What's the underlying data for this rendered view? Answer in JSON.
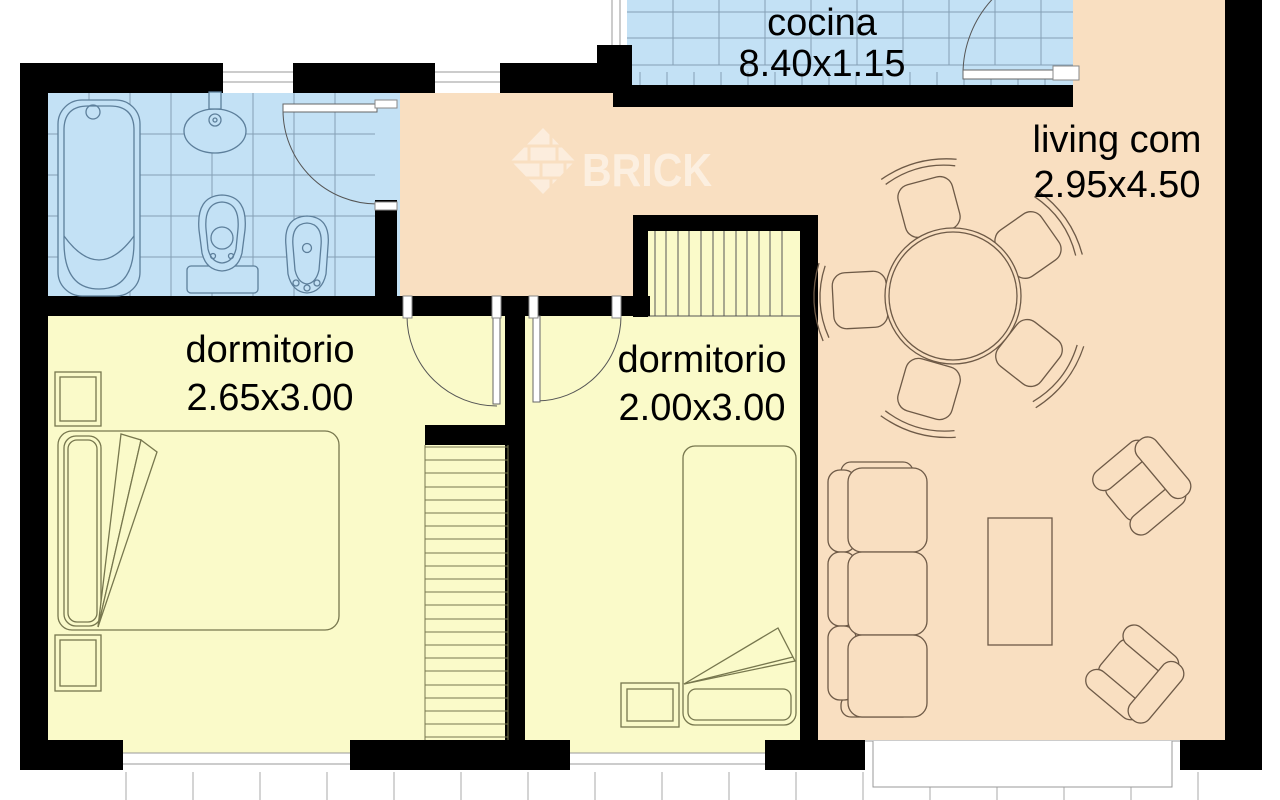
{
  "watermark": {
    "text": "BRICK"
  },
  "rooms": {
    "kitchen": {
      "label": "cocina",
      "dimensions": "8.40x1.15"
    },
    "living": {
      "label": "living com",
      "dimensions": "2.95x4.50"
    },
    "bedroom1": {
      "label": "dormitorio",
      "dimensions": "2.65x3.00"
    },
    "bedroom2": {
      "label": "dormitorio",
      "dimensions": "2.00x3.00"
    }
  },
  "colors": {
    "wall": "#000000",
    "wet_floor": "#c3e1f5",
    "living_floor": "#f9dfc1",
    "bedroom_floor": "#fafac9",
    "living_outline": "#6e5a47",
    "bedroom_outline": "#77774e",
    "bath_outline": "#5d7f9b",
    "grid_line": "#85a0b5",
    "window_line": "#999999"
  }
}
